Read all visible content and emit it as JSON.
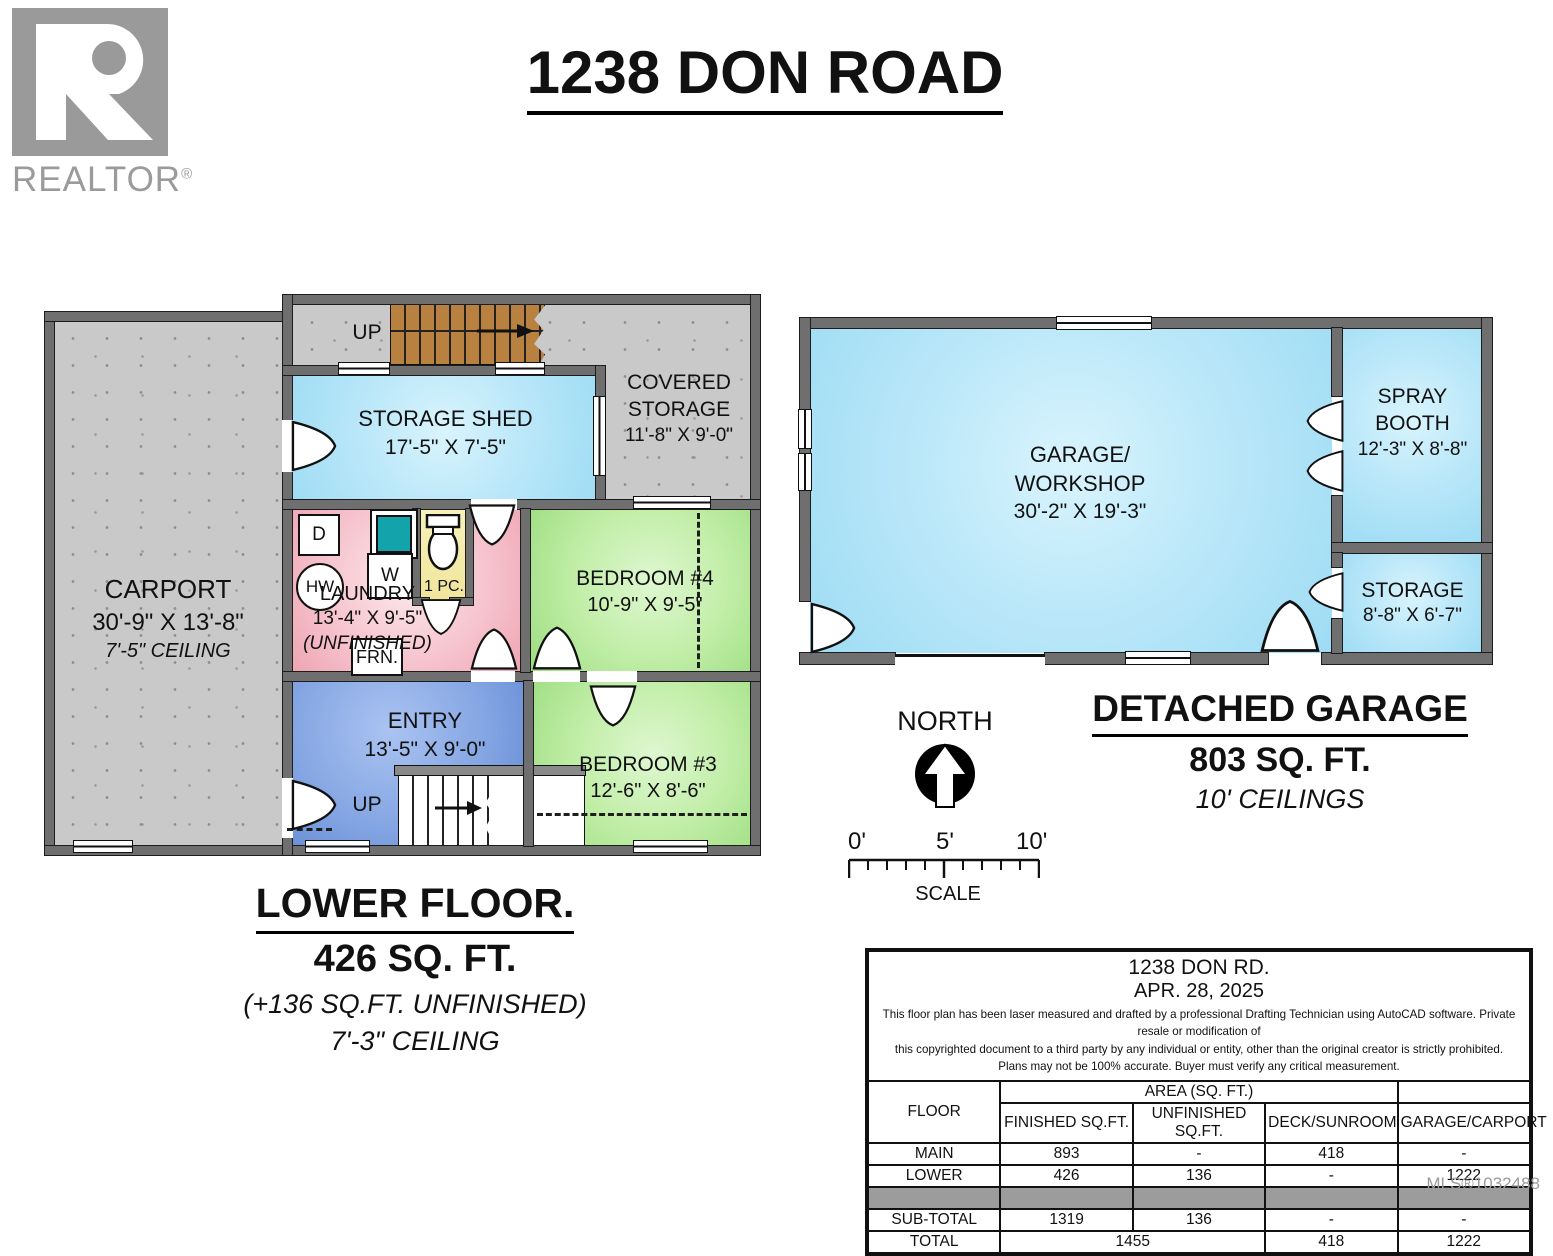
{
  "page": {
    "title": "1238 DON ROAD",
    "mls": "MLS®1032488"
  },
  "logo": {
    "text": "REALTOR",
    "reg": "®"
  },
  "rooms": {
    "carport": {
      "name": "CARPORT",
      "dims": "30'-9\" X 13'-8\"",
      "ceiling": "7'-5\" CEILING"
    },
    "shed": {
      "name": "STORAGE SHED",
      "dims": "17'-5\" X 7'-5\""
    },
    "covered": {
      "line1": "COVERED",
      "line2": "STORAGE",
      "dims": "11'-8\" X 9'-0\""
    },
    "laundry": {
      "name": "LAUNDRY",
      "dims": "13'-4\" X 9'-5\"",
      "note": "(UNFINISHED)"
    },
    "bath": {
      "label": "1 PC."
    },
    "bedroom4": {
      "name": "BEDROOM #4",
      "dims": "10'-9\" X 9'-5\""
    },
    "entry": {
      "name": "ENTRY",
      "dims": "13'-5\" X 9'-0\""
    },
    "bedroom3": {
      "name": "BEDROOM #3",
      "dims": "12'-6\" X 8'-6\""
    }
  },
  "fixtures": {
    "dryer": "D",
    "washer": "W",
    "hot_water": "HW",
    "furnace": "FRN.",
    "up_upper": "UP",
    "up_entry": "UP"
  },
  "lower_caption": {
    "title": "LOWER FLOOR.",
    "area": "426 SQ. FT.",
    "unfinished": "(+136 SQ.FT. UNFINISHED)",
    "ceiling": "7'-3\" CEILING"
  },
  "garage": {
    "workshop": {
      "line1": "GARAGE/",
      "line2": "WORKSHOP",
      "dims": "30'-2\" X 19'-3\""
    },
    "spray": {
      "line1": "SPRAY",
      "line2": "BOOTH",
      "dims": "12'-3\" X 8'-8\""
    },
    "storage": {
      "name": "STORAGE",
      "dims": "8'-8\" X 6'-7\""
    }
  },
  "garage_caption": {
    "title": "DETACHED GARAGE",
    "area": "803 SQ. FT.",
    "ceiling": "10' CEILINGS"
  },
  "compass": {
    "label": "NORTH"
  },
  "scale": {
    "ticks": [
      "0'",
      "5'",
      "10'"
    ],
    "label": "SCALE"
  },
  "table": {
    "address": "1238 DON RD.",
    "date": "APR. 28, 2025",
    "disclaimer": [
      "This floor plan has been laser measured and drafted by a professional Drafting Technician using AutoCAD software. Private resale or modification of",
      "this copyrighted document to a third party by any individual or entity, other than the original creator is strictly prohibited.",
      "Plans may not be 100% accurate.  Buyer must verify any critical measurement."
    ],
    "floor_col": "FLOOR",
    "area_group": "AREA (SQ. FT.)",
    "columns": [
      "FINISHED SQ.FT.",
      "UNFINISHED SQ.FT.",
      "DECK/SUNROOM",
      "GARAGE/CARPORT"
    ],
    "main": {
      "label": "MAIN",
      "finished": "893",
      "unfinished": "-",
      "deck": "418",
      "garage": "-"
    },
    "lower": {
      "label": "LOWER",
      "finished": "426",
      "unfinished": "136",
      "deck": "-",
      "garage": "1222"
    },
    "subtotal": {
      "label": "SUB-TOTAL",
      "finished": "1319",
      "unfinished": "136",
      "deck": "-",
      "garage": "-"
    },
    "total": {
      "label": "TOTAL",
      "combined": "1455",
      "deck": "418",
      "garage": "1222"
    }
  }
}
